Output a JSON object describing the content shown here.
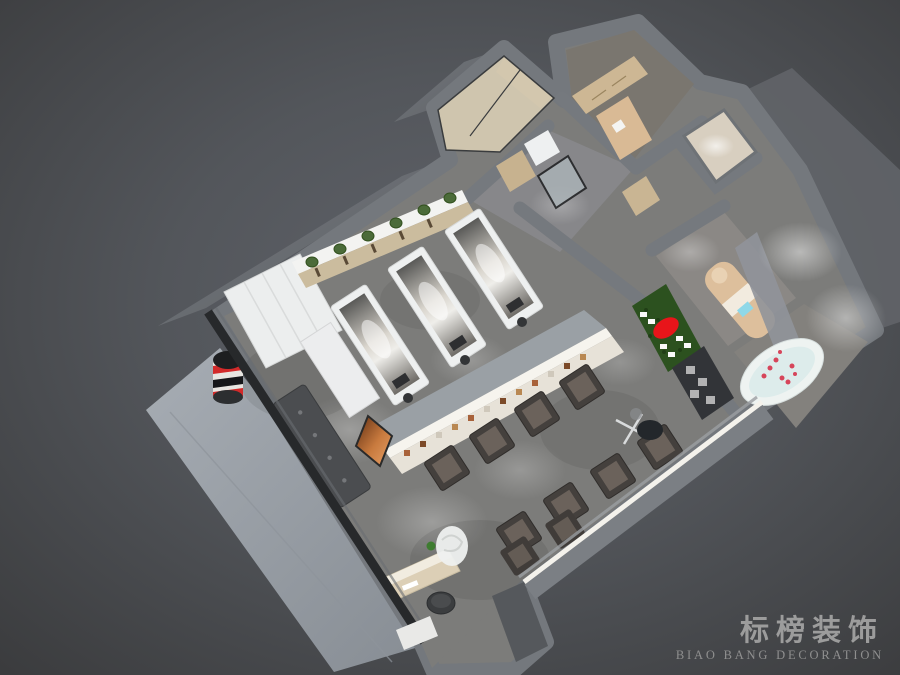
{
  "scene": {
    "kind": "3d-birdseye-interior-render",
    "subject": "barbershop-salon-floorplan-render"
  },
  "watermark": {
    "cn": "标榜装饰",
    "en": "BIAO BANG DECORATION"
  },
  "palette": {
    "background": "#3e3f41",
    "background_glow": "#5e6166",
    "wall_top": "#75797e",
    "wall_face": "#6c7076",
    "dark_edge": "#27292b",
    "floor_concrete": "#7c7c7a",
    "sidewalk": "#9aa0a7",
    "cabinet_white": "#eceeee",
    "shelf_wood": "#cbbc9e",
    "plant_green": "#4b6b39",
    "display_front": "#e7e2d8",
    "armchair": "#44403d",
    "armchair_cushion": "#6b625b",
    "green_wall": "#2c511f",
    "logo_red": "#e8151a",
    "bed_tan": "#ddbf9c",
    "tub_white": "#eef3f1",
    "petal_red": "#d6455a",
    "copper": "#c87a3e",
    "barber_pole_red": "#d22a2a",
    "watermark_gray": "#9c9c9c"
  }
}
